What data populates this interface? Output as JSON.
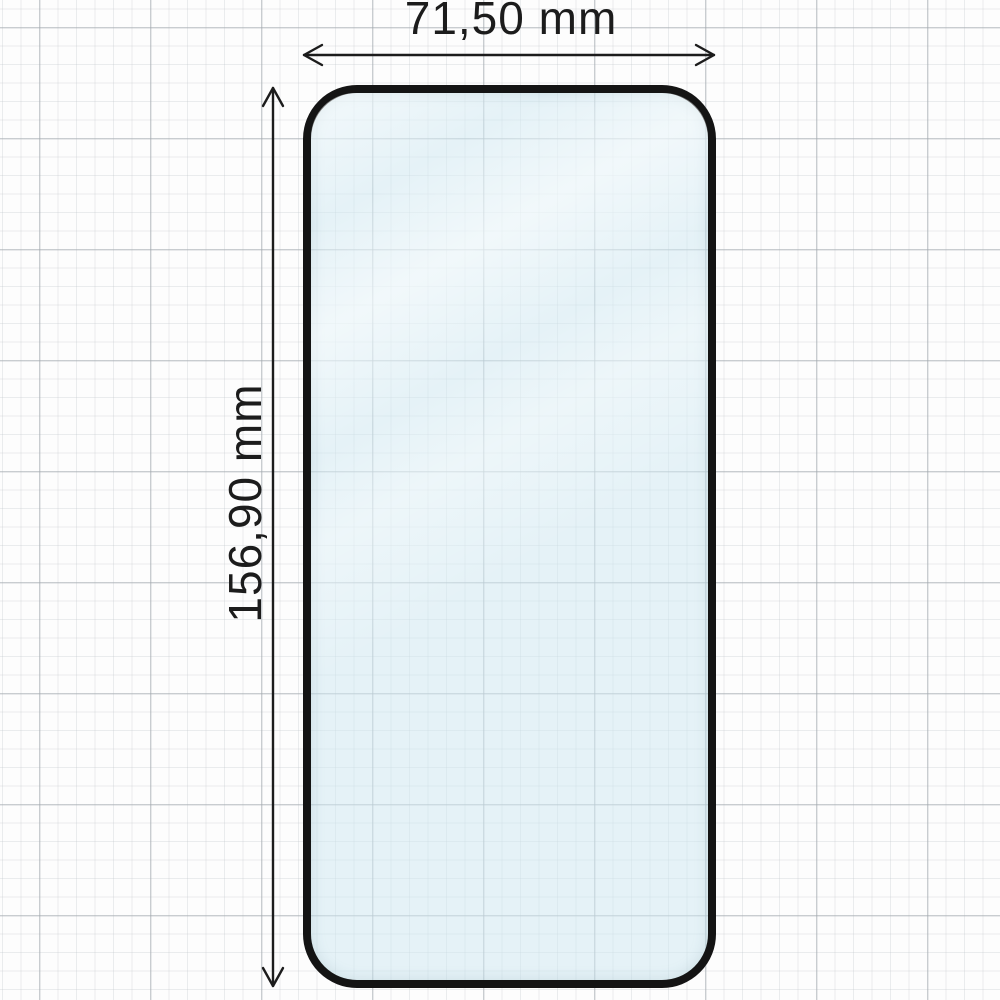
{
  "diagram": {
    "type": "product-dimension-diagram",
    "subject": "tempered-glass-screen-protector",
    "dimensions": {
      "width": {
        "label": "71,50 mm",
        "value_mm": 71.5,
        "arrow": "horizontal-double-arrow"
      },
      "height": {
        "label": "156,90 mm",
        "value_mm": 156.9,
        "arrow": "vertical-double-arrow"
      }
    },
    "background": "graph-paper-grid"
  },
  "colors": {
    "line": "#1c1c1c",
    "glass_border": "#141414",
    "glass_tint": "#e9f2f6",
    "paper": "#fdfdfd",
    "grid_minor": "#ededed",
    "grid_major": "#d8d8d8"
  }
}
